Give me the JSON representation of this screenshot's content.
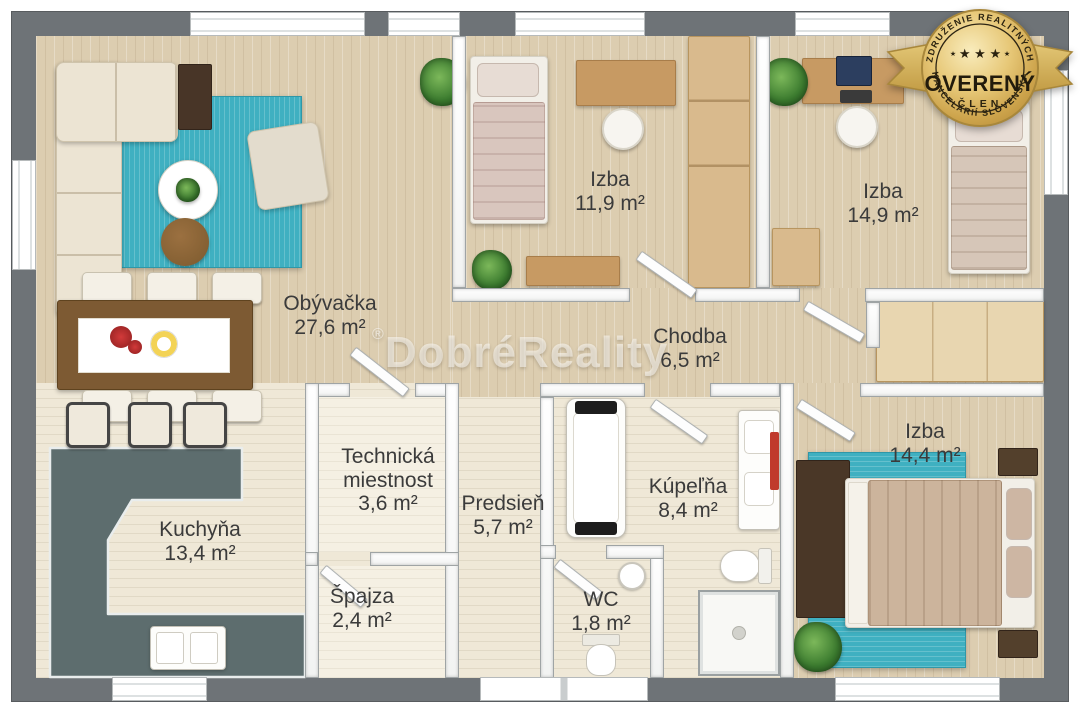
{
  "plan": {
    "title": "3D floor plan",
    "rooms": [
      {
        "id": "obyvacka",
        "name": "Obývačka",
        "area": "27,6 m²"
      },
      {
        "id": "izba1",
        "name": "Izba",
        "area": "11,9 m²"
      },
      {
        "id": "izba2",
        "name": "Izba",
        "area": "14,9 m²"
      },
      {
        "id": "chodba",
        "name": "Chodba",
        "area": "6,5 m²"
      },
      {
        "id": "technicka",
        "name": "Technická miestnost",
        "area": "3,6 m²"
      },
      {
        "id": "predsien",
        "name": "Predsieň",
        "area": "5,7 m²"
      },
      {
        "id": "kupelna",
        "name": "Kúpeľňa",
        "area": "8,4 m²"
      },
      {
        "id": "izba3",
        "name": "Izba",
        "area": "14,4 m²"
      },
      {
        "id": "kuchyna",
        "name": "Kuchyňa",
        "area": "13,4 m²"
      },
      {
        "id": "spajza",
        "name": "Špajza",
        "area": "2,4 m²"
      },
      {
        "id": "wc",
        "name": "WC",
        "area": "1,8 m²"
      }
    ]
  },
  "rooms": [
    {
      "name": "Obývačka",
      "area": "27,6 m²"
    },
    {
      "name": "Izba",
      "area": "11,9 m²"
    },
    {
      "name": "Izba",
      "area": "14,9 m²"
    },
    {
      "name": "Chodba",
      "area": "6,5 m²"
    },
    {
      "name": "Technická miestnost",
      "area": "3,6 m²"
    },
    {
      "name": "Predsieň",
      "area": "5,7 m²"
    },
    {
      "name": "Kúpeľňa",
      "area": "8,4 m²"
    },
    {
      "name": "Izba",
      "area": "14,4 m²"
    },
    {
      "name": "Kuchyňa",
      "area": "13,4 m²"
    },
    {
      "name": "Špajza",
      "area": "2,4 m²"
    },
    {
      "name": "WC",
      "area": "1,8 m²"
    }
  ],
  "watermark": {
    "symbol": "®",
    "text": "DobréReality"
  },
  "badge": {
    "arc_top": "ZDRUŽENIE REALITNÝCH",
    "arc_bottom": "KANCELÁRIÍ SLOVENSKA",
    "stars": "★ ★ ★",
    "star_small": "★",
    "title": "OVERENÝ",
    "subtitle": "ČLEN"
  },
  "colors": {
    "outer_wall": "#6e7377",
    "wood_floor": "#dccdb0",
    "tile_floor": "#efe8d7",
    "rug_teal": "#3fb0c1",
    "kitchen_counter": "#5d6d6e",
    "badge_gold": "#d4af55",
    "radiator_red": "#c03a2c"
  }
}
